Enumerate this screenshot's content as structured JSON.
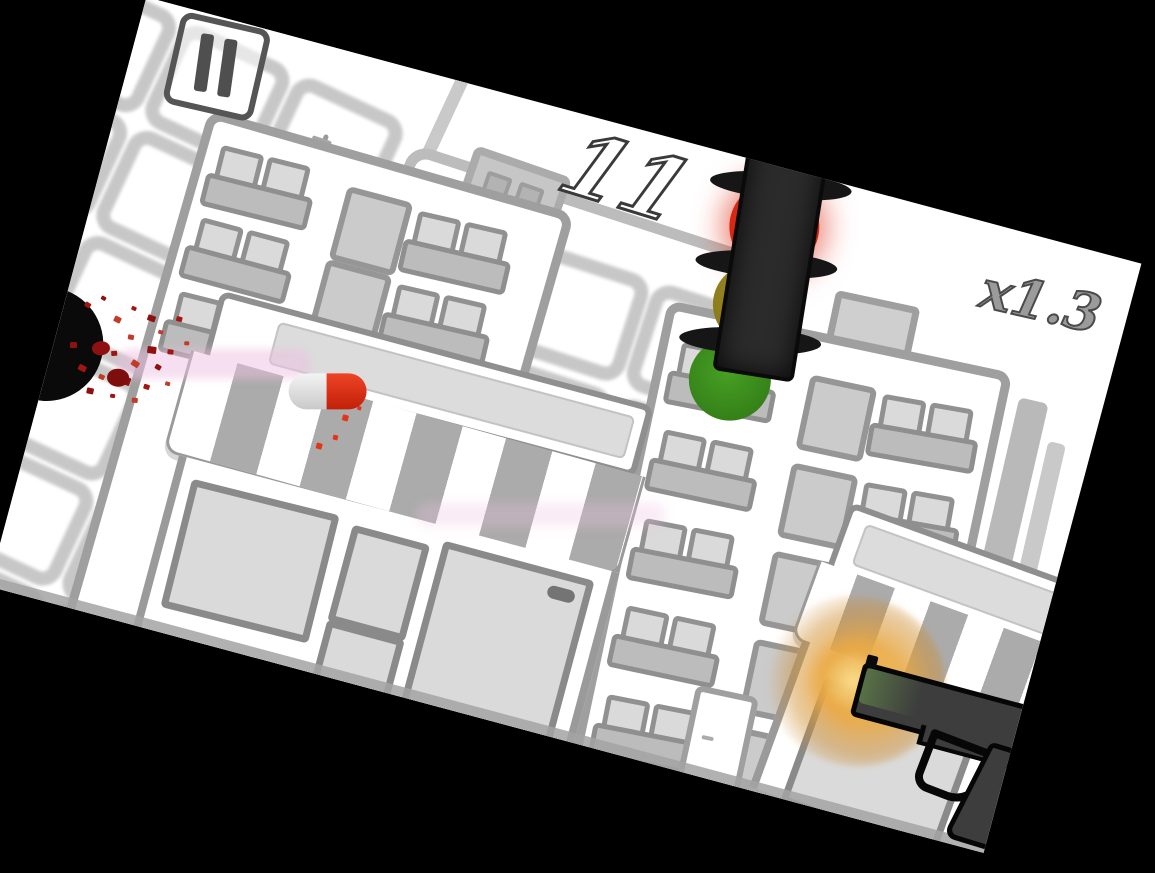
{
  "hud": {
    "score": "11",
    "multiplier": "x1.3",
    "pause_icon": "pause-icon"
  },
  "scene": {
    "description_items": [
      "city-buildings",
      "storefront-awnings",
      "traffic-light",
      "pistol",
      "capsule-projectile",
      "blood-splatter",
      "enemy-silhouette",
      "utility-pole"
    ],
    "traffic_light_state": "red"
  },
  "colors": {
    "background": "#000000",
    "canvas_bg": "#ffffff",
    "building_border": "#9f9f9f",
    "window_grey": "#c5c5c5",
    "awning_stripe": "#ababab",
    "traffic_body": "#2b2b2b",
    "red_light": "#d82812",
    "yellow_light": "#958321",
    "green_light": "#3c8c1e",
    "pill_red": "#e23418",
    "pill_silver": "#e8e8e8",
    "trail_pink": "#eec0e0",
    "blood_red": "#a31512",
    "flash_orange": "#e5a53c",
    "gun_grey": "#3d3d3d",
    "hud_fill": "#ffffff",
    "hud_stroke": "#3a3a3a",
    "multiplier_grey": "#9b9b9b"
  }
}
